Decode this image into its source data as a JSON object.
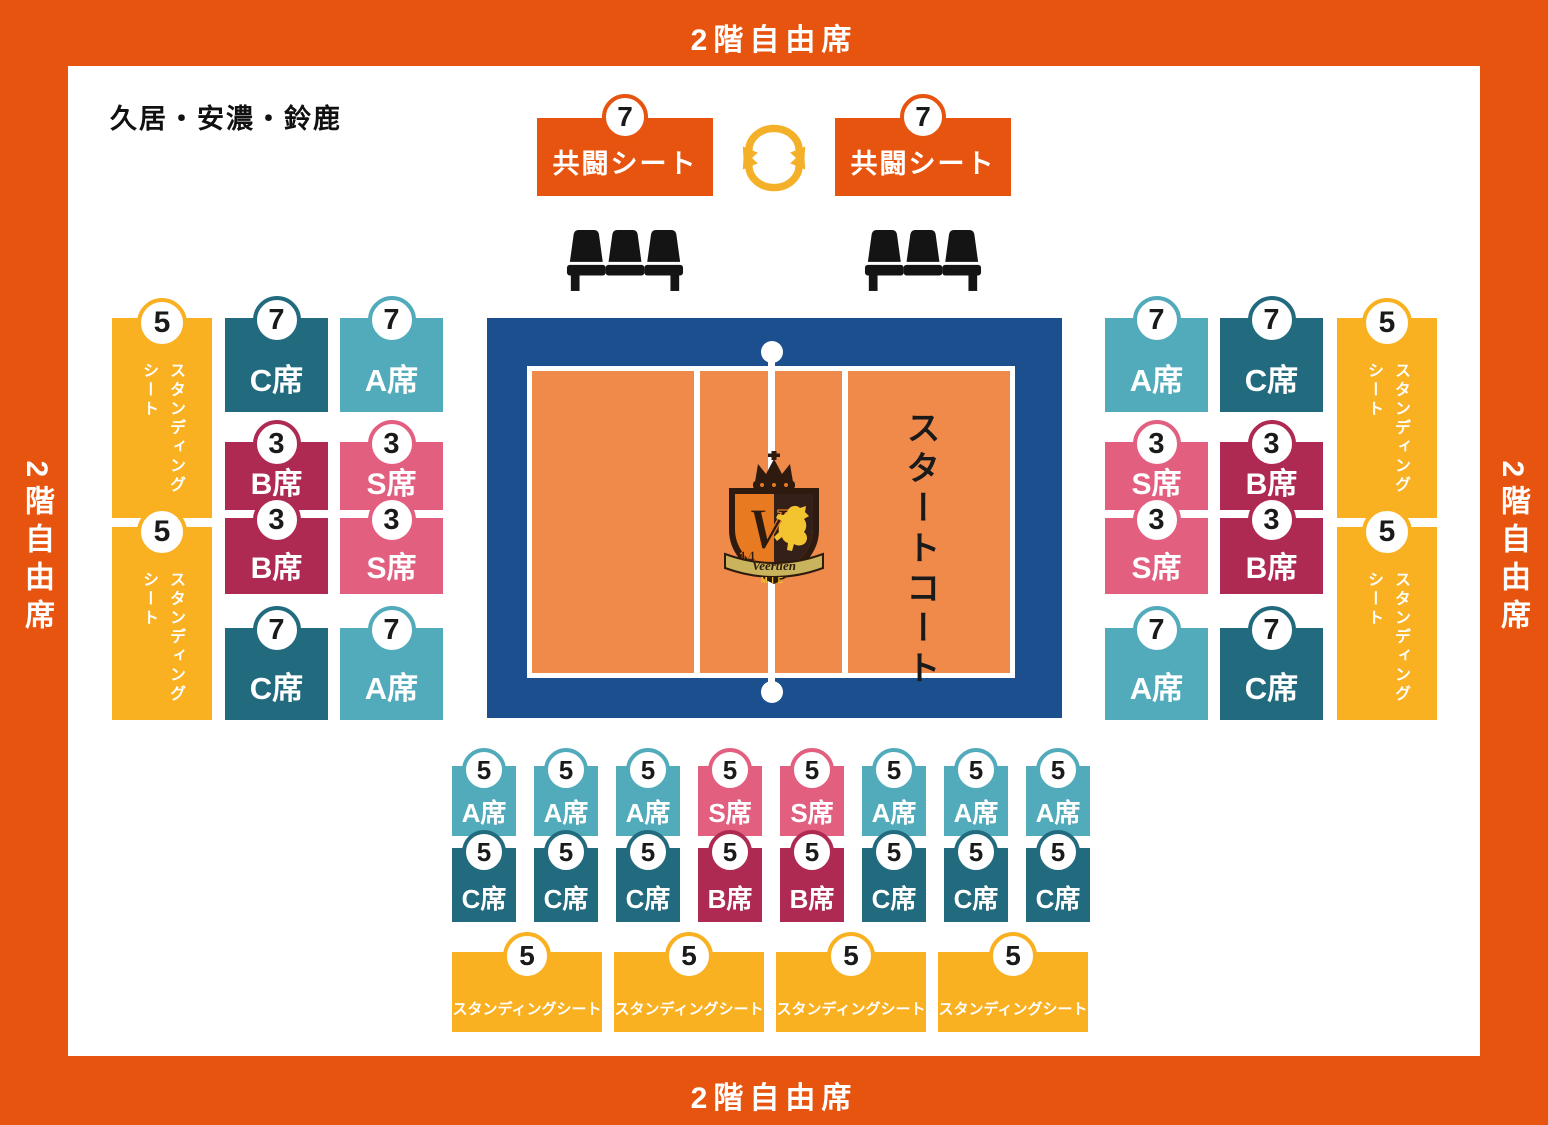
{
  "frame": {
    "top_label": "2階自由席",
    "bottom_label": "2階自由席",
    "left_label": "2階自由席",
    "right_label": "2階自由席"
  },
  "region_label": "久居・安濃・鈴鹿",
  "kyoto": {
    "left": {
      "badge": "7",
      "label": "共闘シート"
    },
    "right": {
      "badge": "7",
      "label": "共闘シート"
    }
  },
  "court": {
    "start_label": "スタートコート",
    "logo": {
      "initial": "V",
      "number": "14",
      "name": "Veertien",
      "region": "MIE"
    }
  },
  "left_section": {
    "standing": [
      {
        "badge": "5",
        "lines": [
          "スタンディング",
          "シート"
        ]
      },
      {
        "badge": "5",
        "lines": [
          "スタンディング",
          "シート"
        ]
      }
    ],
    "columns": [
      {
        "blocks": [
          {
            "badge": "7",
            "label": "C席",
            "type": "c"
          },
          {
            "badge": "3",
            "label": "B席",
            "type": "b"
          },
          {
            "badge": "3",
            "label": "B席",
            "type": "b"
          },
          {
            "badge": "7",
            "label": "C席",
            "type": "c"
          }
        ]
      },
      {
        "blocks": [
          {
            "badge": "7",
            "label": "A席",
            "type": "a"
          },
          {
            "badge": "3",
            "label": "S席",
            "type": "s"
          },
          {
            "badge": "3",
            "label": "S席",
            "type": "s"
          },
          {
            "badge": "7",
            "label": "A席",
            "type": "a"
          }
        ]
      }
    ]
  },
  "right_section": {
    "columns": [
      {
        "blocks": [
          {
            "badge": "7",
            "label": "A席",
            "type": "a"
          },
          {
            "badge": "3",
            "label": "S席",
            "type": "s"
          },
          {
            "badge": "3",
            "label": "S席",
            "type": "s"
          },
          {
            "badge": "7",
            "label": "A席",
            "type": "a"
          }
        ]
      },
      {
        "blocks": [
          {
            "badge": "7",
            "label": "C席",
            "type": "c"
          },
          {
            "badge": "3",
            "label": "B席",
            "type": "b"
          },
          {
            "badge": "3",
            "label": "B席",
            "type": "b"
          },
          {
            "badge": "7",
            "label": "C席",
            "type": "c"
          }
        ]
      }
    ],
    "standing": [
      {
        "badge": "5",
        "lines": [
          "スタンディング",
          "シート"
        ]
      },
      {
        "badge": "5",
        "lines": [
          "スタンディング",
          "シート"
        ]
      }
    ]
  },
  "bottom_section": {
    "row1": [
      {
        "badge": "5",
        "label": "A席",
        "type": "a"
      },
      {
        "badge": "5",
        "label": "A席",
        "type": "a"
      },
      {
        "badge": "5",
        "label": "A席",
        "type": "a"
      },
      {
        "badge": "5",
        "label": "S席",
        "type": "s"
      },
      {
        "badge": "5",
        "label": "S席",
        "type": "s"
      },
      {
        "badge": "5",
        "label": "A席",
        "type": "a"
      },
      {
        "badge": "5",
        "label": "A席",
        "type": "a"
      },
      {
        "badge": "5",
        "label": "A席",
        "type": "a"
      }
    ],
    "row2": [
      {
        "badge": "5",
        "label": "C席",
        "type": "c"
      },
      {
        "badge": "5",
        "label": "C席",
        "type": "c"
      },
      {
        "badge": "5",
        "label": "C席",
        "type": "c"
      },
      {
        "badge": "5",
        "label": "B席",
        "type": "b"
      },
      {
        "badge": "5",
        "label": "B席",
        "type": "b"
      },
      {
        "badge": "5",
        "label": "C席",
        "type": "c"
      },
      {
        "badge": "5",
        "label": "C席",
        "type": "c"
      },
      {
        "badge": "5",
        "label": "C席",
        "type": "c"
      }
    ],
    "standing": [
      {
        "badge": "5",
        "label": "スタンディングシート"
      },
      {
        "badge": "5",
        "label": "スタンディングシート"
      },
      {
        "badge": "5",
        "label": "スタンディングシート"
      },
      {
        "badge": "5",
        "label": "スタンディングシート"
      }
    ]
  },
  "colors": {
    "frame_orange": "#E7540F",
    "standing_yellow": "#F9B021",
    "a_seat_teal": "#52ABBB",
    "c_seat_dark_teal": "#226B7E",
    "b_seat_crimson": "#AE2A52",
    "s_seat_pink": "#E25F80",
    "court_blue": "#1C4F8E",
    "court_orange": "#EF8A4B",
    "arrow_yellow": "#F5B02A",
    "seat_icon_black": "#141414"
  }
}
